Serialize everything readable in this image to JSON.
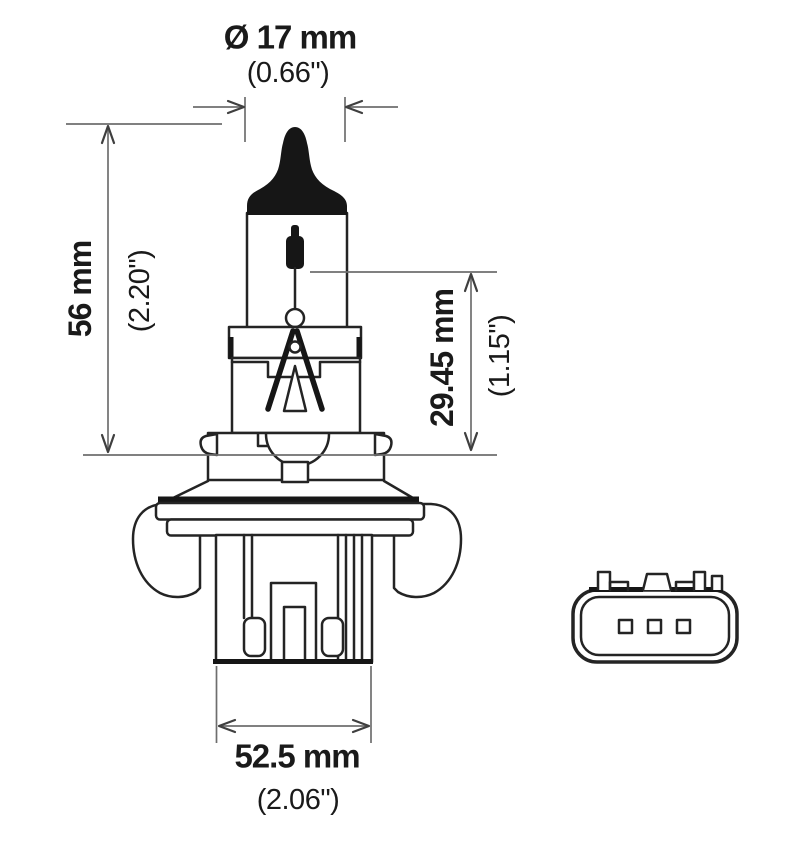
{
  "meta": {
    "title": "Halogen bulb technical dimension drawing",
    "views": [
      "bulb-side-view",
      "connector-face-view"
    ]
  },
  "colors": {
    "background": "#ffffff",
    "outline": "#242424",
    "solid_fill": "#161616",
    "dimension_line": "#6e6e6e",
    "text": "#1a1a1a"
  },
  "dimensions": {
    "diameter": {
      "mm": "Ø 17 mm",
      "inch": "(0.66\")"
    },
    "overall_length": {
      "mm": "56 mm",
      "inch": "(2.20\")"
    },
    "light_center_length": {
      "mm": "29.45 mm",
      "inch": "(1.15\")"
    },
    "base_width": {
      "mm": "52.5 mm",
      "inch": "(2.06\")"
    }
  },
  "connector": {
    "pin_count": 3
  }
}
